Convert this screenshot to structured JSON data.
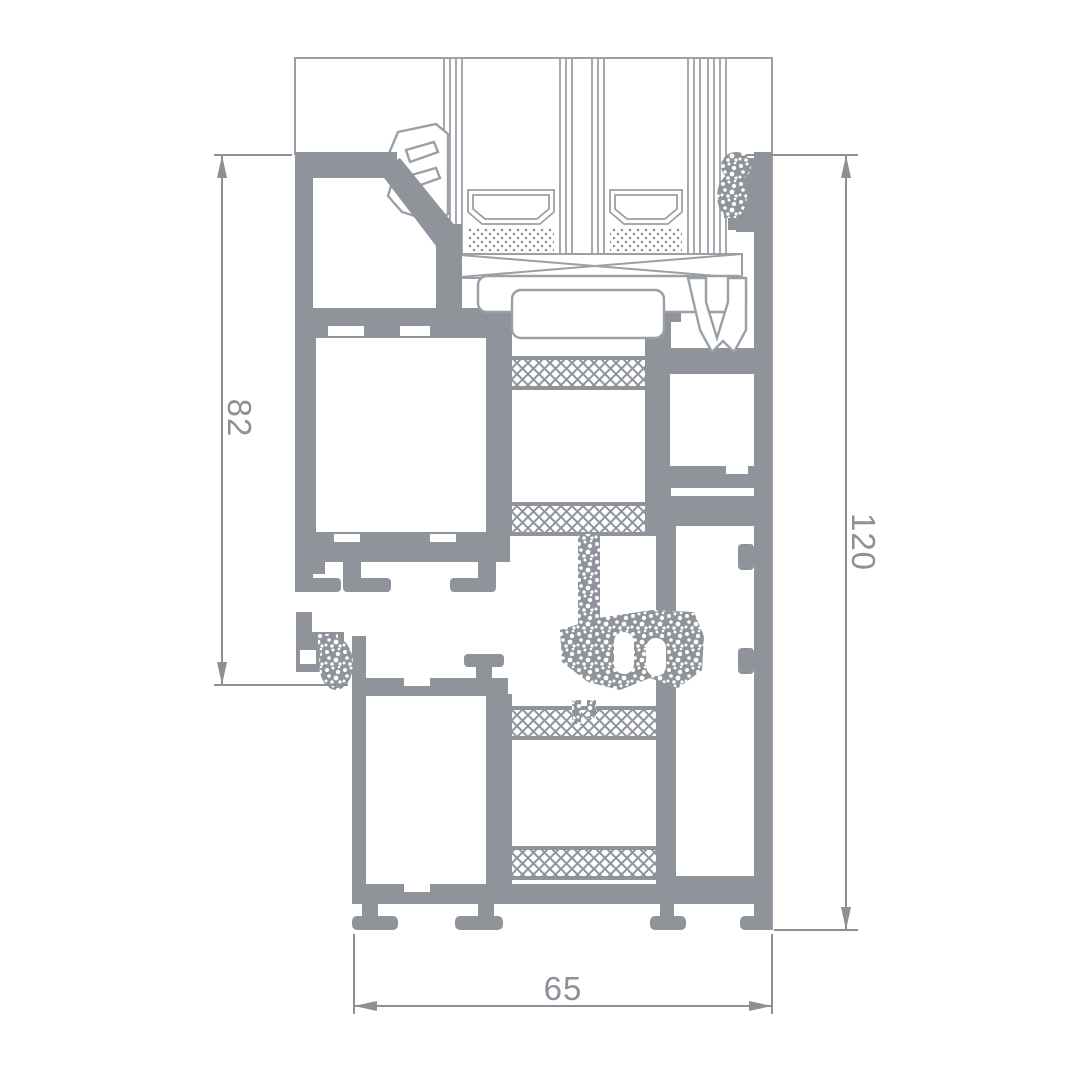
{
  "drawing": {
    "kind": "aluminium window profile cross-section",
    "dimensions": {
      "left": {
        "value": "82"
      },
      "right": {
        "value": "120"
      },
      "bottom": {
        "value": "65"
      }
    }
  },
  "colors": {
    "profile": "#8e9499",
    "thin_line": "#9aa0a6",
    "dimension": "#8b9196",
    "background": "#ffffff"
  }
}
